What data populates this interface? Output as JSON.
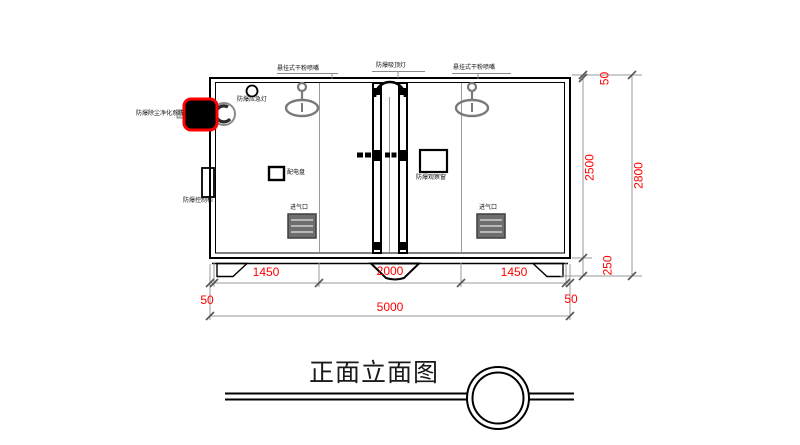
{
  "drawing": {
    "title": "正面立面图",
    "view_type": "front-elevation"
  },
  "annotations": {
    "nozzle_left": "悬挂式干粉喷嘴",
    "ceiling_light": "防爆吸顶灯",
    "nozzle_right": "悬挂式干粉喷嘴",
    "emergency_light": "防爆应急灯",
    "dust_purifier": "防爆除尘净化系统",
    "control_cabinet": "防爆控制柜",
    "power_panel": "配电盘",
    "observation_window": "防爆观察窗",
    "air_inlet_left": "进气口",
    "air_inlet_right": "进气口"
  },
  "dimensions": {
    "roof_thickness": "50",
    "inner_height": "2500",
    "total_height": "2800",
    "base_height": "250",
    "bay_left": "1450",
    "bay_center": "2000",
    "bay_right": "1450",
    "wall_left": "50",
    "wall_right": "50",
    "total_width": "5000"
  },
  "colors": {
    "dimension_text": "#ff0000",
    "highlight_outline": "#ff0000",
    "drawing_line": "#000000",
    "symbol_gray": "#7a7a7a",
    "background": "#ffffff"
  }
}
